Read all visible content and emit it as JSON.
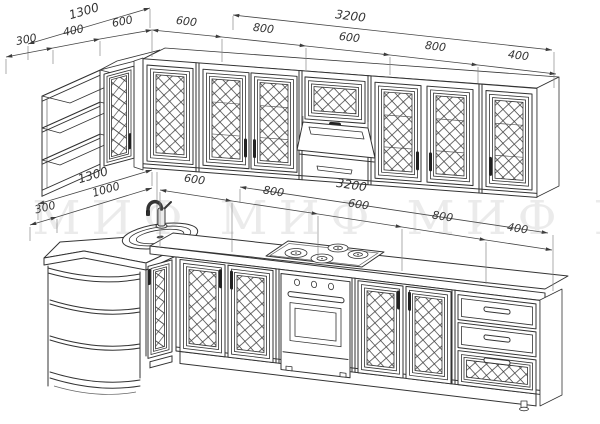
{
  "watermark": {
    "text": "МИФ МИФ МИФ МИФ МИФ"
  },
  "dimensions": {
    "wall_row": {
      "overall_left": "1300",
      "left_segments": [
        "300",
        "400",
        "600"
      ],
      "overall_main": "3200",
      "main_segments": [
        "600",
        "800",
        "600",
        "800",
        "400"
      ]
    },
    "base_row": {
      "overall_left": "1300",
      "left_segments": [
        "300",
        "1000"
      ],
      "overall_main": "3200",
      "main_segments": [
        "600",
        "800",
        "600",
        "800",
        "400"
      ]
    }
  },
  "colors": {
    "line": "#333333",
    "dim_text": "#333333",
    "watermark": "#777777",
    "background": "#ffffff"
  }
}
